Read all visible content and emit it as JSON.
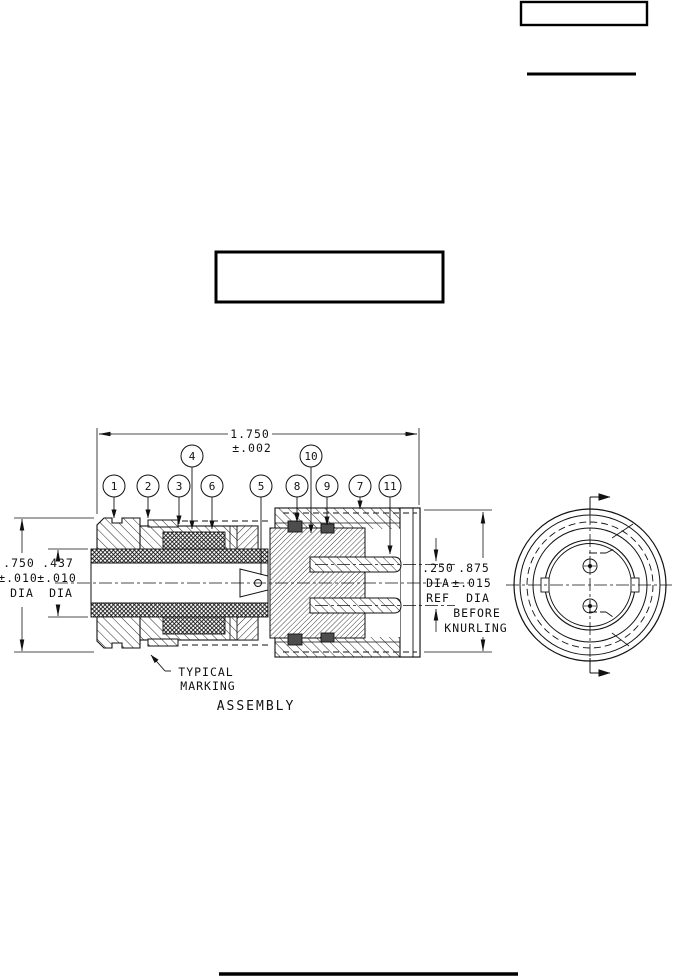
{
  "drawing": {
    "view_label": "ASSEMBLY",
    "callouts": [
      "1",
      "2",
      "3",
      "4",
      "5",
      "6",
      "7",
      "8",
      "9",
      "10",
      "11"
    ],
    "dim_length": {
      "value": "1.750",
      "tol": "±.002"
    },
    "dim_outer": {
      "value": ".750",
      "tol": "±.010",
      "unit": "DIA"
    },
    "dim_cable": {
      "value": ".437",
      "tol": "±.010",
      "unit": "DIA"
    },
    "dim_pin": {
      "l1": ".250",
      "l2": "DIA",
      "l3": "REF"
    },
    "dim_knurl": {
      "l1": ".875",
      "l2": "±.015",
      "l3": "DIA",
      "l4": "BEFORE",
      "l5": "KNURLING"
    },
    "marking_note": {
      "l1": "TYPICAL",
      "l2": "MARKING"
    },
    "colors": {
      "ink": "#111111",
      "seal": "#4d4d4d",
      "paper": "#ffffff"
    }
  }
}
